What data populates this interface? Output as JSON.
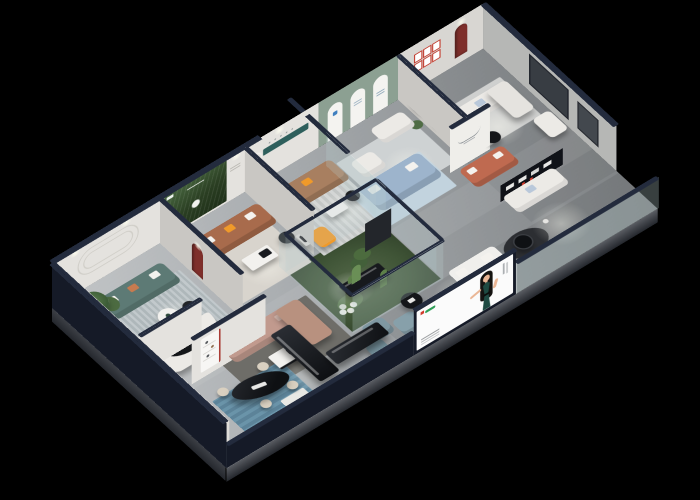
{
  "scene": {
    "description": "Isometric 3D cutaway render of a furniture showroom floor plan at night",
    "background": "#000000",
    "width": 700,
    "height": 500
  },
  "palette": {
    "bg": "#000000",
    "wall-outer": "#151a27",
    "wall-cap": "#232b3d",
    "wall-inner": "#e4e2de",
    "wall-side": "#c9c7c3",
    "wall-right": "#b6b7b5",
    "floor-hi": "#bcbfc1",
    "floor-lo": "#8f9396",
    "sage": "#8ca092",
    "teal-strip": "#2e5f5c",
    "forest-dark": "#1f3019",
    "forest-light": "#47663f",
    "arch-red": "#7e2f2b",
    "frame-red": "#c0392b",
    "sofa-teal": "#5d7a75",
    "sofa-brown": "#a86b4c",
    "sofa-tan": "#a87f60",
    "pillow-orange": "#f09a2a",
    "sofa-pink": "#c19a8e",
    "sofa-blue": "#9db4cc",
    "sofa-rust": "#bf6a50",
    "sofa-sage": "#9aaa90",
    "sofa-white": "#eceae6",
    "chair-cream": "#d9d0c0",
    "table-black": "#17191d",
    "table-white": "#f2f1ee",
    "rug-gray": "#6e6d68",
    "rug-blue": "#c2d3de",
    "glass": "#b8cfd0",
    "atrium-green": "#3f5436",
    "cactus": "#6a8f56",
    "billboard-bg": "#fbfbfb",
    "dress-teal": "#1e4a42",
    "skin": "#eab695",
    "hair": "#151311",
    "logo-red": "#d03a2b",
    "logo-green": "#2e9e57",
    "bench-black": "#101218",
    "slab": "#43464c",
    "slab-dark": "#24272d"
  },
  "rooms": [
    {
      "id": "lounge-room",
      "label": "Lounge room with curved wall molding and teal sofa"
    },
    {
      "id": "forest-room",
      "label": "Forest mural room with brown leather sofa"
    },
    {
      "id": "leather-room",
      "label": "Tan leather sofa room with teal wall strip"
    },
    {
      "id": "arch-room",
      "label": "Sage green gallery room with three arched panels"
    },
    {
      "id": "guest-room",
      "label": "Guest room with six red picture frames and red arch niche"
    },
    {
      "id": "media-room",
      "label": "Front-right lounge with black product shelf"
    },
    {
      "id": "atrium",
      "label": "Glass-walled cactus atrium garden"
    },
    {
      "id": "showroom",
      "label": "Central showroom with pink sectional sofa"
    },
    {
      "id": "dining",
      "label": "Dining display area with black oval table"
    },
    {
      "id": "billboard-zone",
      "label": "Front billboard lounge with blue-gray armchairs"
    }
  ],
  "billboard": {
    "panel_bg": "#fbfbfb",
    "figure": "woman with long black hair in dark teal evening dress",
    "logo_colors": [
      "#d03a2b",
      "#2e9e57"
    ]
  },
  "decor": {
    "forest_poster": "pine forest artwork on back wall",
    "arch_panels_count": 3,
    "red_frames_count": 6,
    "red_arch_niches_count": 2,
    "atrium_plants": "cacti and white hydrangeas",
    "glass_walls": "navy-capped glass partitions"
  }
}
